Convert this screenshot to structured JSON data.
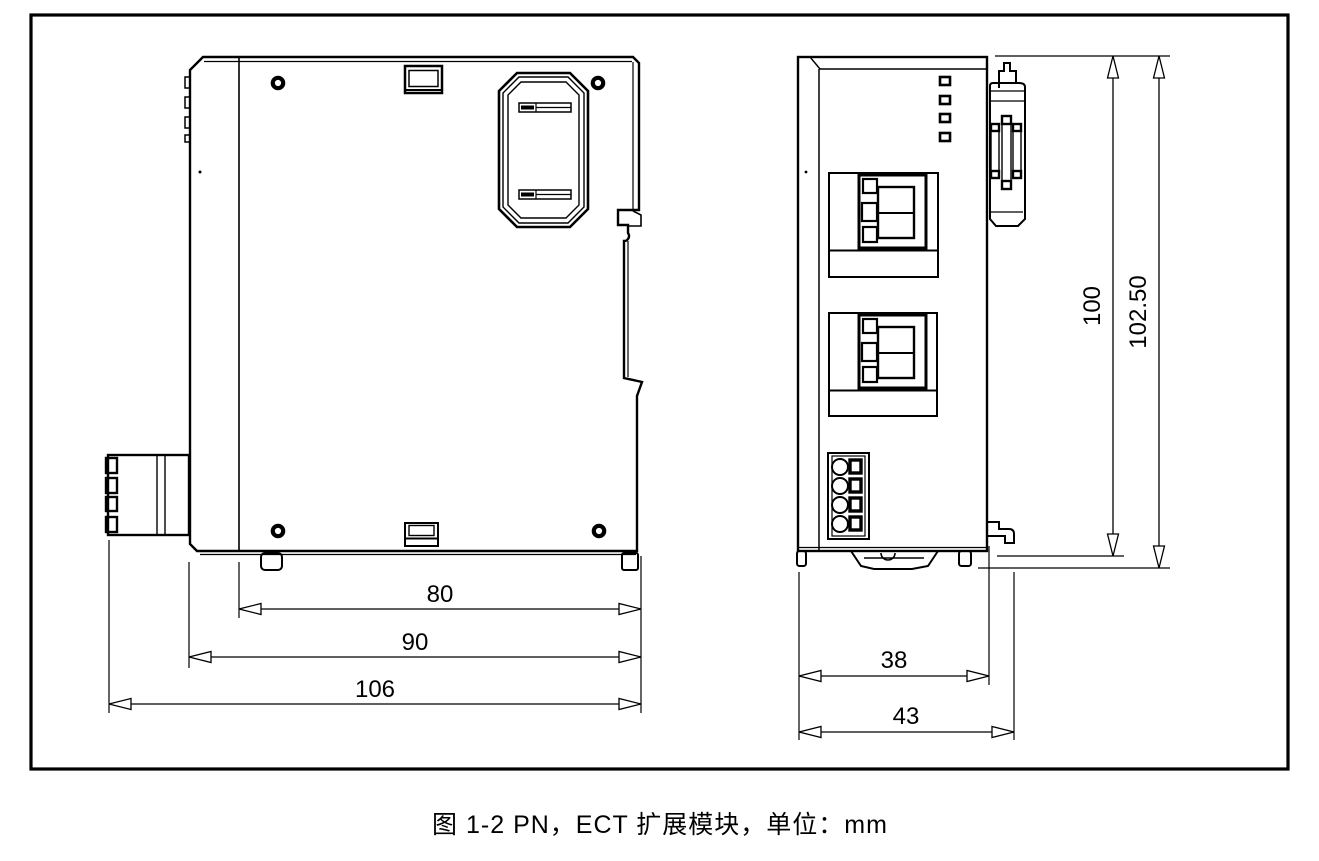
{
  "caption": "图 1-2 PN，ECT 扩展模块，单位：mm",
  "unit": "mm",
  "drawing": {
    "side_view": {
      "title": "side view",
      "width_dims": [
        {
          "label": "80"
        },
        {
          "label": "90"
        },
        {
          "label": "106"
        }
      ]
    },
    "front_view": {
      "title": "front view",
      "width_dims": [
        {
          "label": "38"
        },
        {
          "label": "43"
        }
      ],
      "height_dims": [
        {
          "label": "100"
        },
        {
          "label": "102.50"
        }
      ]
    }
  },
  "colors": {
    "line": "#000000",
    "background": "#ffffff"
  }
}
